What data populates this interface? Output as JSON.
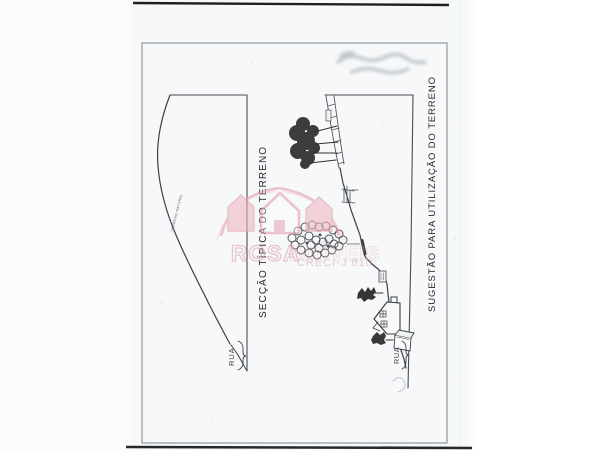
{
  "page": {
    "background": "#ffffff",
    "sheet_tint": "#f6f8fa",
    "frame_color": "#8a8f93",
    "ink_color": "#3c3f42"
  },
  "left_diagram": {
    "title": "SECÇÃO  TÍPICA  DO  TERRENO",
    "terrain_label": "TERRENO NATURAL",
    "street_label": "RUA"
  },
  "right_diagram": {
    "title": "SUGESTÃO  PARA  UTILIZAÇÃO  DO  TERRENO",
    "street_label": "RUA"
  },
  "watermark": {
    "brand_word1": "ROSA",
    "brand_word2": "IMÓVEIS",
    "registration": "CRECI-J 810",
    "pink": "#e59fae",
    "pink_fill": "#eeb6c2"
  }
}
